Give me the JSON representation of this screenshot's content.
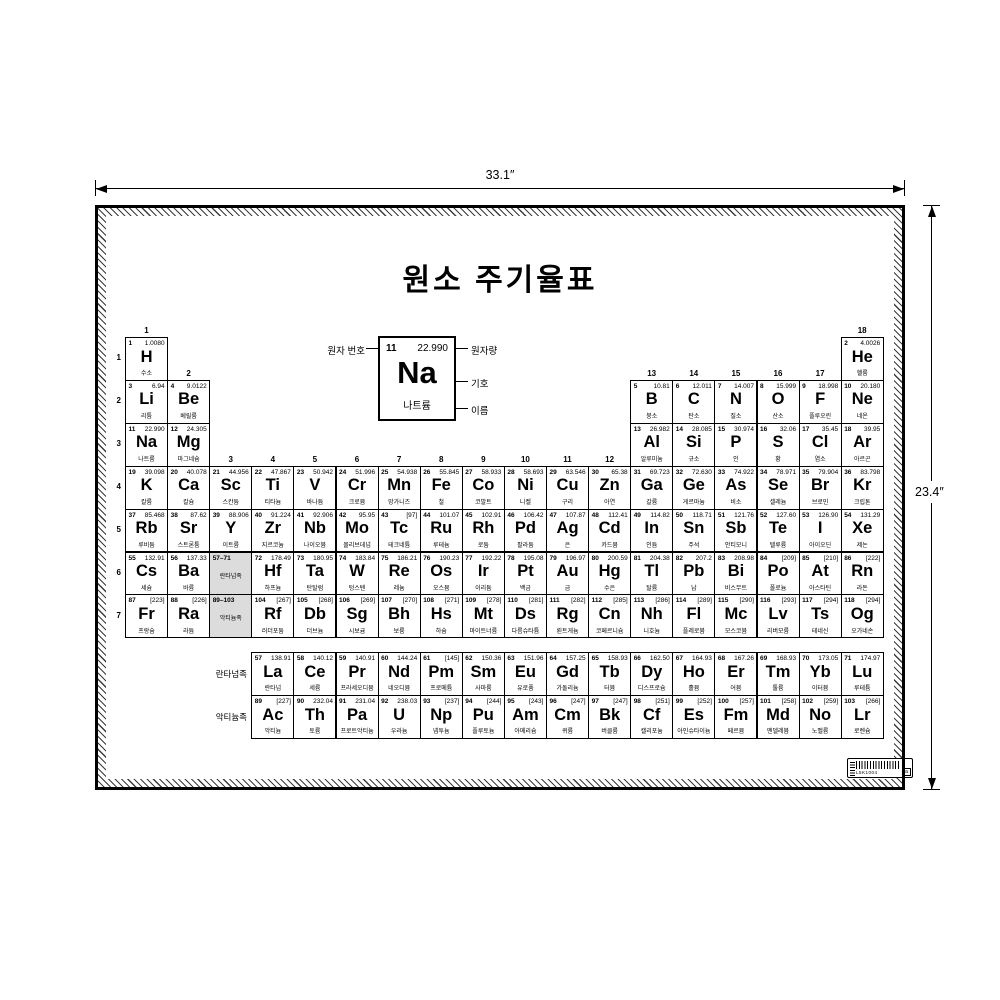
{
  "poster": {
    "title": "원소 주기율표"
  },
  "dimensions": {
    "width": "33.1″",
    "height": "23.4″"
  },
  "legend": {
    "atomic_number_label": "원자 번호",
    "atomic_mass_label": "원자량",
    "symbol_label": "기호",
    "name_label": "이름",
    "example_number": "11",
    "example_mass": "22.990",
    "example_symbol": "Na",
    "example_name": "나트륨"
  },
  "barcode": {
    "text": "L5K1004",
    "box_letter": "a"
  },
  "table": {
    "period_labels": [
      "1",
      "2",
      "3",
      "4",
      "5",
      "6",
      "7"
    ],
    "group_labels": [
      {
        "g": "1",
        "col": 1,
        "row": 1
      },
      {
        "g": "2",
        "col": 2,
        "row": 2
      },
      {
        "g": "3",
        "col": 3,
        "row": 4
      },
      {
        "g": "4",
        "col": 4,
        "row": 4
      },
      {
        "g": "5",
        "col": 5,
        "row": 4
      },
      {
        "g": "6",
        "col": 6,
        "row": 4
      },
      {
        "g": "7",
        "col": 7,
        "row": 4
      },
      {
        "g": "8",
        "col": 8,
        "row": 4
      },
      {
        "g": "9",
        "col": 9,
        "row": 4
      },
      {
        "g": "10",
        "col": 10,
        "row": 4
      },
      {
        "g": "11",
        "col": 11,
        "row": 4
      },
      {
        "g": "12",
        "col": 12,
        "row": 4
      },
      {
        "g": "13",
        "col": 13,
        "row": 2
      },
      {
        "g": "14",
        "col": 14,
        "row": 2
      },
      {
        "g": "15",
        "col": 15,
        "row": 2
      },
      {
        "g": "16",
        "col": 16,
        "row": 2
      },
      {
        "g": "17",
        "col": 17,
        "row": 2
      },
      {
        "g": "18",
        "col": 18,
        "row": 1
      }
    ],
    "series_labels": {
      "lanthanides": "란타넘족",
      "actinides": "악티늄족"
    },
    "placeholders": [
      {
        "range": "57–71",
        "label": "란타넘족",
        "r": 6,
        "c": 3
      },
      {
        "range": "89–103",
        "label": "악티늄족",
        "r": 7,
        "c": 3
      }
    ],
    "elements": [
      {
        "n": "1",
        "s": "H",
        "m": "1.0080",
        "k": "수소",
        "r": 1,
        "c": 1
      },
      {
        "n": "2",
        "s": "He",
        "m": "4.0026",
        "k": "헬륨",
        "r": 1,
        "c": 18
      },
      {
        "n": "3",
        "s": "Li",
        "m": "6.94",
        "k": "리튬",
        "r": 2,
        "c": 1
      },
      {
        "n": "4",
        "s": "Be",
        "m": "9.0122",
        "k": "베릴륨",
        "r": 2,
        "c": 2
      },
      {
        "n": "5",
        "s": "B",
        "m": "10.81",
        "k": "붕소",
        "r": 2,
        "c": 13
      },
      {
        "n": "6",
        "s": "C",
        "m": "12.011",
        "k": "탄소",
        "r": 2,
        "c": 14
      },
      {
        "n": "7",
        "s": "N",
        "m": "14.007",
        "k": "질소",
        "r": 2,
        "c": 15
      },
      {
        "n": "8",
        "s": "O",
        "m": "15.999",
        "k": "산소",
        "r": 2,
        "c": 16
      },
      {
        "n": "9",
        "s": "F",
        "m": "18.998",
        "k": "플루오린",
        "r": 2,
        "c": 17
      },
      {
        "n": "10",
        "s": "Ne",
        "m": "20.180",
        "k": "네온",
        "r": 2,
        "c": 18
      },
      {
        "n": "11",
        "s": "Na",
        "m": "22.990",
        "k": "나트륨",
        "r": 3,
        "c": 1
      },
      {
        "n": "12",
        "s": "Mg",
        "m": "24.305",
        "k": "마그네슘",
        "r": 3,
        "c": 2
      },
      {
        "n": "13",
        "s": "Al",
        "m": "26.982",
        "k": "알루미늄",
        "r": 3,
        "c": 13
      },
      {
        "n": "14",
        "s": "Si",
        "m": "28.085",
        "k": "규소",
        "r": 3,
        "c": 14
      },
      {
        "n": "15",
        "s": "P",
        "m": "30.974",
        "k": "인",
        "r": 3,
        "c": 15
      },
      {
        "n": "16",
        "s": "S",
        "m": "32.06",
        "k": "황",
        "r": 3,
        "c": 16
      },
      {
        "n": "17",
        "s": "Cl",
        "m": "35.45",
        "k": "염소",
        "r": 3,
        "c": 17
      },
      {
        "n": "18",
        "s": "Ar",
        "m": "39.95",
        "k": "아르곤",
        "r": 3,
        "c": 18
      },
      {
        "n": "19",
        "s": "K",
        "m": "39.098",
        "k": "칼륨",
        "r": 4,
        "c": 1
      },
      {
        "n": "20",
        "s": "Ca",
        "m": "40.078",
        "k": "칼슘",
        "r": 4,
        "c": 2
      },
      {
        "n": "21",
        "s": "Sc",
        "m": "44.956",
        "k": "스칸듐",
        "r": 4,
        "c": 3
      },
      {
        "n": "22",
        "s": "Ti",
        "m": "47.867",
        "k": "티타늄",
        "r": 4,
        "c": 4
      },
      {
        "n": "23",
        "s": "V",
        "m": "50.942",
        "k": "바나듐",
        "r": 4,
        "c": 5
      },
      {
        "n": "24",
        "s": "Cr",
        "m": "51.996",
        "k": "크로뮴",
        "r": 4,
        "c": 6
      },
      {
        "n": "25",
        "s": "Mn",
        "m": "54.938",
        "k": "망가니즈",
        "r": 4,
        "c": 7
      },
      {
        "n": "26",
        "s": "Fe",
        "m": "55.845",
        "k": "철",
        "r": 4,
        "c": 8
      },
      {
        "n": "27",
        "s": "Co",
        "m": "58.933",
        "k": "코발트",
        "r": 4,
        "c": 9
      },
      {
        "n": "28",
        "s": "Ni",
        "m": "58.693",
        "k": "니켈",
        "r": 4,
        "c": 10
      },
      {
        "n": "29",
        "s": "Cu",
        "m": "63.546",
        "k": "구리",
        "r": 4,
        "c": 11
      },
      {
        "n": "30",
        "s": "Zn",
        "m": "65.38",
        "k": "아연",
        "r": 4,
        "c": 12
      },
      {
        "n": "31",
        "s": "Ga",
        "m": "69.723",
        "k": "갈륨",
        "r": 4,
        "c": 13
      },
      {
        "n": "32",
        "s": "Ge",
        "m": "72.630",
        "k": "게르마늄",
        "r": 4,
        "c": 14
      },
      {
        "n": "33",
        "s": "As",
        "m": "74.922",
        "k": "비소",
        "r": 4,
        "c": 15
      },
      {
        "n": "34",
        "s": "Se",
        "m": "78.971",
        "k": "셀레늄",
        "r": 4,
        "c": 16
      },
      {
        "n": "35",
        "s": "Br",
        "m": "79.904",
        "k": "브로민",
        "r": 4,
        "c": 17
      },
      {
        "n": "36",
        "s": "Kr",
        "m": "83.798",
        "k": "크립톤",
        "r": 4,
        "c": 18
      },
      {
        "n": "37",
        "s": "Rb",
        "m": "85.468",
        "k": "루비듐",
        "r": 5,
        "c": 1
      },
      {
        "n": "38",
        "s": "Sr",
        "m": "87.62",
        "k": "스트론튬",
        "r": 5,
        "c": 2
      },
      {
        "n": "39",
        "s": "Y",
        "m": "88.906",
        "k": "이트륨",
        "r": 5,
        "c": 3
      },
      {
        "n": "40",
        "s": "Zr",
        "m": "91.224",
        "k": "지르코늄",
        "r": 5,
        "c": 4
      },
      {
        "n": "41",
        "s": "Nb",
        "m": "92.906",
        "k": "나이오븀",
        "r": 5,
        "c": 5
      },
      {
        "n": "42",
        "s": "Mo",
        "m": "95.95",
        "k": "몰리브데넘",
        "r": 5,
        "c": 6
      },
      {
        "n": "43",
        "s": "Tc",
        "m": "[97]",
        "k": "테크네튬",
        "r": 5,
        "c": 7
      },
      {
        "n": "44",
        "s": "Ru",
        "m": "101.07",
        "k": "루테늄",
        "r": 5,
        "c": 8
      },
      {
        "n": "45",
        "s": "Rh",
        "m": "102.91",
        "k": "로듐",
        "r": 5,
        "c": 9
      },
      {
        "n": "46",
        "s": "Pd",
        "m": "106.42",
        "k": "팔라듐",
        "r": 5,
        "c": 10
      },
      {
        "n": "47",
        "s": "Ag",
        "m": "107.87",
        "k": "은",
        "r": 5,
        "c": 11
      },
      {
        "n": "48",
        "s": "Cd",
        "m": "112.41",
        "k": "카드뮴",
        "r": 5,
        "c": 12
      },
      {
        "n": "49",
        "s": "In",
        "m": "114.82",
        "k": "인듐",
        "r": 5,
        "c": 13
      },
      {
        "n": "50",
        "s": "Sn",
        "m": "118.71",
        "k": "주석",
        "r": 5,
        "c": 14
      },
      {
        "n": "51",
        "s": "Sb",
        "m": "121.76",
        "k": "안티모니",
        "r": 5,
        "c": 15
      },
      {
        "n": "52",
        "s": "Te",
        "m": "127.60",
        "k": "텔루륨",
        "r": 5,
        "c": 16
      },
      {
        "n": "53",
        "s": "I",
        "m": "126.90",
        "k": "아이오딘",
        "r": 5,
        "c": 17
      },
      {
        "n": "54",
        "s": "Xe",
        "m": "131.29",
        "k": "제논",
        "r": 5,
        "c": 18
      },
      {
        "n": "55",
        "s": "Cs",
        "m": "132.91",
        "k": "세슘",
        "r": 6,
        "c": 1
      },
      {
        "n": "56",
        "s": "Ba",
        "m": "137.33",
        "k": "바륨",
        "r": 6,
        "c": 2
      },
      {
        "n": "72",
        "s": "Hf",
        "m": "178.49",
        "k": "하프늄",
        "r": 6,
        "c": 4
      },
      {
        "n": "73",
        "s": "Ta",
        "m": "180.95",
        "k": "탄탈럼",
        "r": 6,
        "c": 5
      },
      {
        "n": "74",
        "s": "W",
        "m": "183.84",
        "k": "텅스텐",
        "r": 6,
        "c": 6
      },
      {
        "n": "75",
        "s": "Re",
        "m": "186.21",
        "k": "레늄",
        "r": 6,
        "c": 7
      },
      {
        "n": "76",
        "s": "Os",
        "m": "190.23",
        "k": "오스뮴",
        "r": 6,
        "c": 8
      },
      {
        "n": "77",
        "s": "Ir",
        "m": "192.22",
        "k": "이리듐",
        "r": 6,
        "c": 9
      },
      {
        "n": "78",
        "s": "Pt",
        "m": "195.08",
        "k": "백금",
        "r": 6,
        "c": 10
      },
      {
        "n": "79",
        "s": "Au",
        "m": "196.97",
        "k": "금",
        "r": 6,
        "c": 11
      },
      {
        "n": "80",
        "s": "Hg",
        "m": "200.59",
        "k": "수은",
        "r": 6,
        "c": 12
      },
      {
        "n": "81",
        "s": "Tl",
        "m": "204.38",
        "k": "탈륨",
        "r": 6,
        "c": 13
      },
      {
        "n": "82",
        "s": "Pb",
        "m": "207.2",
        "k": "납",
        "r": 6,
        "c": 14
      },
      {
        "n": "83",
        "s": "Bi",
        "m": "208.98",
        "k": "비스무트",
        "r": 6,
        "c": 15
      },
      {
        "n": "84",
        "s": "Po",
        "m": "[209]",
        "k": "폴로늄",
        "r": 6,
        "c": 16
      },
      {
        "n": "85",
        "s": "At",
        "m": "[210]",
        "k": "아스타틴",
        "r": 6,
        "c": 17
      },
      {
        "n": "86",
        "s": "Rn",
        "m": "[222]",
        "k": "라돈",
        "r": 6,
        "c": 18
      },
      {
        "n": "87",
        "s": "Fr",
        "m": "[223]",
        "k": "프랑슘",
        "r": 7,
        "c": 1
      },
      {
        "n": "88",
        "s": "Ra",
        "m": "[226]",
        "k": "라듐",
        "r": 7,
        "c": 2
      },
      {
        "n": "104",
        "s": "Rf",
        "m": "[267]",
        "k": "러더포듐",
        "r": 7,
        "c": 4
      },
      {
        "n": "105",
        "s": "Db",
        "m": "[268]",
        "k": "더브늄",
        "r": 7,
        "c": 5
      },
      {
        "n": "106",
        "s": "Sg",
        "m": "[269]",
        "k": "시보귬",
        "r": 7,
        "c": 6
      },
      {
        "n": "107",
        "s": "Bh",
        "m": "[270]",
        "k": "보륨",
        "r": 7,
        "c": 7
      },
      {
        "n": "108",
        "s": "Hs",
        "m": "[271]",
        "k": "하슘",
        "r": 7,
        "c": 8
      },
      {
        "n": "109",
        "s": "Mt",
        "m": "[278]",
        "k": "마이트너륨",
        "r": 7,
        "c": 9
      },
      {
        "n": "110",
        "s": "Ds",
        "m": "[281]",
        "k": "다름슈타튬",
        "r": 7,
        "c": 10
      },
      {
        "n": "111",
        "s": "Rg",
        "m": "[282]",
        "k": "뢴트게늄",
        "r": 7,
        "c": 11
      },
      {
        "n": "112",
        "s": "Cn",
        "m": "[285]",
        "k": "코페르니슘",
        "r": 7,
        "c": 12
      },
      {
        "n": "113",
        "s": "Nh",
        "m": "[286]",
        "k": "니호늄",
        "r": 7,
        "c": 13
      },
      {
        "n": "114",
        "s": "Fl",
        "m": "[289]",
        "k": "플레로븀",
        "r": 7,
        "c": 14
      },
      {
        "n": "115",
        "s": "Mc",
        "m": "[290]",
        "k": "모스코븀",
        "r": 7,
        "c": 15
      },
      {
        "n": "116",
        "s": "Lv",
        "m": "[293]",
        "k": "리버모륨",
        "r": 7,
        "c": 16
      },
      {
        "n": "117",
        "s": "Ts",
        "m": "[294]",
        "k": "테네신",
        "r": 7,
        "c": 17
      },
      {
        "n": "118",
        "s": "Og",
        "m": "[294]",
        "k": "오가네손",
        "r": 7,
        "c": 18
      },
      {
        "n": "57",
        "s": "La",
        "m": "138.91",
        "k": "란타넘",
        "r": 8,
        "c": 4
      },
      {
        "n": "58",
        "s": "Ce",
        "m": "140.12",
        "k": "세륨",
        "r": 8,
        "c": 5
      },
      {
        "n": "59",
        "s": "Pr",
        "m": "140.91",
        "k": "프라세오디뮴",
        "r": 8,
        "c": 6
      },
      {
        "n": "60",
        "s": "Nd",
        "m": "144.24",
        "k": "네오디뮴",
        "r": 8,
        "c": 7
      },
      {
        "n": "61",
        "s": "Pm",
        "m": "[145]",
        "k": "프로메튬",
        "r": 8,
        "c": 8
      },
      {
        "n": "62",
        "s": "Sm",
        "m": "150.36",
        "k": "사마륨",
        "r": 8,
        "c": 9
      },
      {
        "n": "63",
        "s": "Eu",
        "m": "151.96",
        "k": "유로퓸",
        "r": 8,
        "c": 10
      },
      {
        "n": "64",
        "s": "Gd",
        "m": "157.25",
        "k": "가돌리늄",
        "r": 8,
        "c": 11
      },
      {
        "n": "65",
        "s": "Tb",
        "m": "158.93",
        "k": "터븀",
        "r": 8,
        "c": 12
      },
      {
        "n": "66",
        "s": "Dy",
        "m": "162.50",
        "k": "디스프로슘",
        "r": 8,
        "c": 13
      },
      {
        "n": "67",
        "s": "Ho",
        "m": "164.93",
        "k": "홀뮴",
        "r": 8,
        "c": 14
      },
      {
        "n": "68",
        "s": "Er",
        "m": "167.26",
        "k": "어븀",
        "r": 8,
        "c": 15
      },
      {
        "n": "69",
        "s": "Tm",
        "m": "168.93",
        "k": "툴륨",
        "r": 8,
        "c": 16
      },
      {
        "n": "70",
        "s": "Yb",
        "m": "173.05",
        "k": "이터븀",
        "r": 8,
        "c": 17
      },
      {
        "n": "71",
        "s": "Lu",
        "m": "174.97",
        "k": "루테튬",
        "r": 8,
        "c": 18
      },
      {
        "n": "89",
        "s": "Ac",
        "m": "[227]",
        "k": "악티늄",
        "r": 9,
        "c": 4
      },
      {
        "n": "90",
        "s": "Th",
        "m": "232.04",
        "k": "토륨",
        "r": 9,
        "c": 5
      },
      {
        "n": "91",
        "s": "Pa",
        "m": "231.04",
        "k": "프로트악티늄",
        "r": 9,
        "c": 6
      },
      {
        "n": "92",
        "s": "U",
        "m": "238.03",
        "k": "우라늄",
        "r": 9,
        "c": 7
      },
      {
        "n": "93",
        "s": "Np",
        "m": "[237]",
        "k": "넵투늄",
        "r": 9,
        "c": 8
      },
      {
        "n": "94",
        "s": "Pu",
        "m": "[244]",
        "k": "플루토늄",
        "r": 9,
        "c": 9
      },
      {
        "n": "95",
        "s": "Am",
        "m": "[243]",
        "k": "아메리슘",
        "r": 9,
        "c": 10
      },
      {
        "n": "96",
        "s": "Cm",
        "m": "[247]",
        "k": "퀴륨",
        "r": 9,
        "c": 11
      },
      {
        "n": "97",
        "s": "Bk",
        "m": "[247]",
        "k": "버클륨",
        "r": 9,
        "c": 12
      },
      {
        "n": "98",
        "s": "Cf",
        "m": "[251]",
        "k": "캘리포늄",
        "r": 9,
        "c": 13
      },
      {
        "n": "99",
        "s": "Es",
        "m": "[252]",
        "k": "아인슈타이늄",
        "r": 9,
        "c": 14
      },
      {
        "n": "100",
        "s": "Fm",
        "m": "[257]",
        "k": "페르뮴",
        "r": 9,
        "c": 15
      },
      {
        "n": "101",
        "s": "Md",
        "m": "[258]",
        "k": "멘델레븀",
        "r": 9,
        "c": 16
      },
      {
        "n": "102",
        "s": "No",
        "m": "[259]",
        "k": "노벨륨",
        "r": 9,
        "c": 17
      },
      {
        "n": "103",
        "s": "Lr",
        "m": "[266]",
        "k": "로렌슘",
        "r": 9,
        "c": 18
      }
    ]
  }
}
